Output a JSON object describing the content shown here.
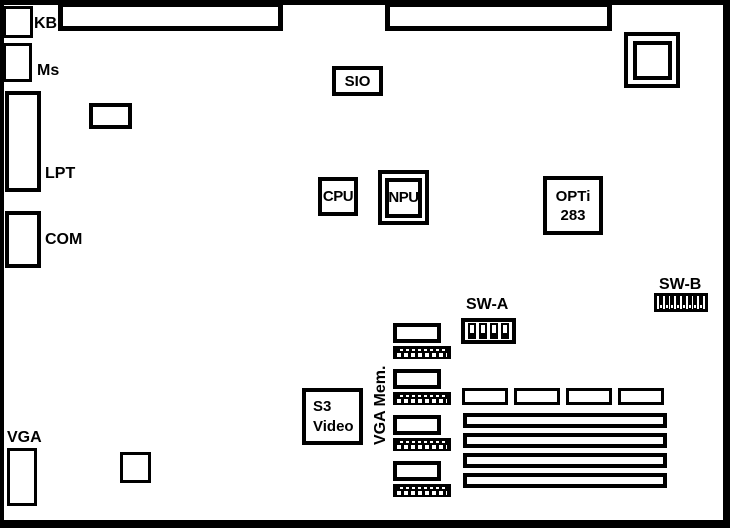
{
  "connectors": {
    "kb": "KB",
    "mouse": "Ms",
    "parallel": "LPT",
    "serial": "COM",
    "vga": "VGA"
  },
  "chips": {
    "sio": "SIO",
    "cpu": "CPU",
    "npu": "NPU",
    "chipset_line1": "OPTi",
    "chipset_line2": "283",
    "video_line1": "S3",
    "video_line2": "Video"
  },
  "switches": {
    "sw_a_label": "SW-A",
    "sw_a_positions": 4,
    "sw_b_label": "SW-B",
    "sw_b_positions": 8
  },
  "memory": {
    "vga_mem_label": "VGA Mem.",
    "vga_mem_module_count": 4,
    "ram_slot_small_count": 4,
    "ram_slot_long_count": 4
  },
  "colors": {
    "outline": "#000000",
    "background": "#ffffff"
  }
}
